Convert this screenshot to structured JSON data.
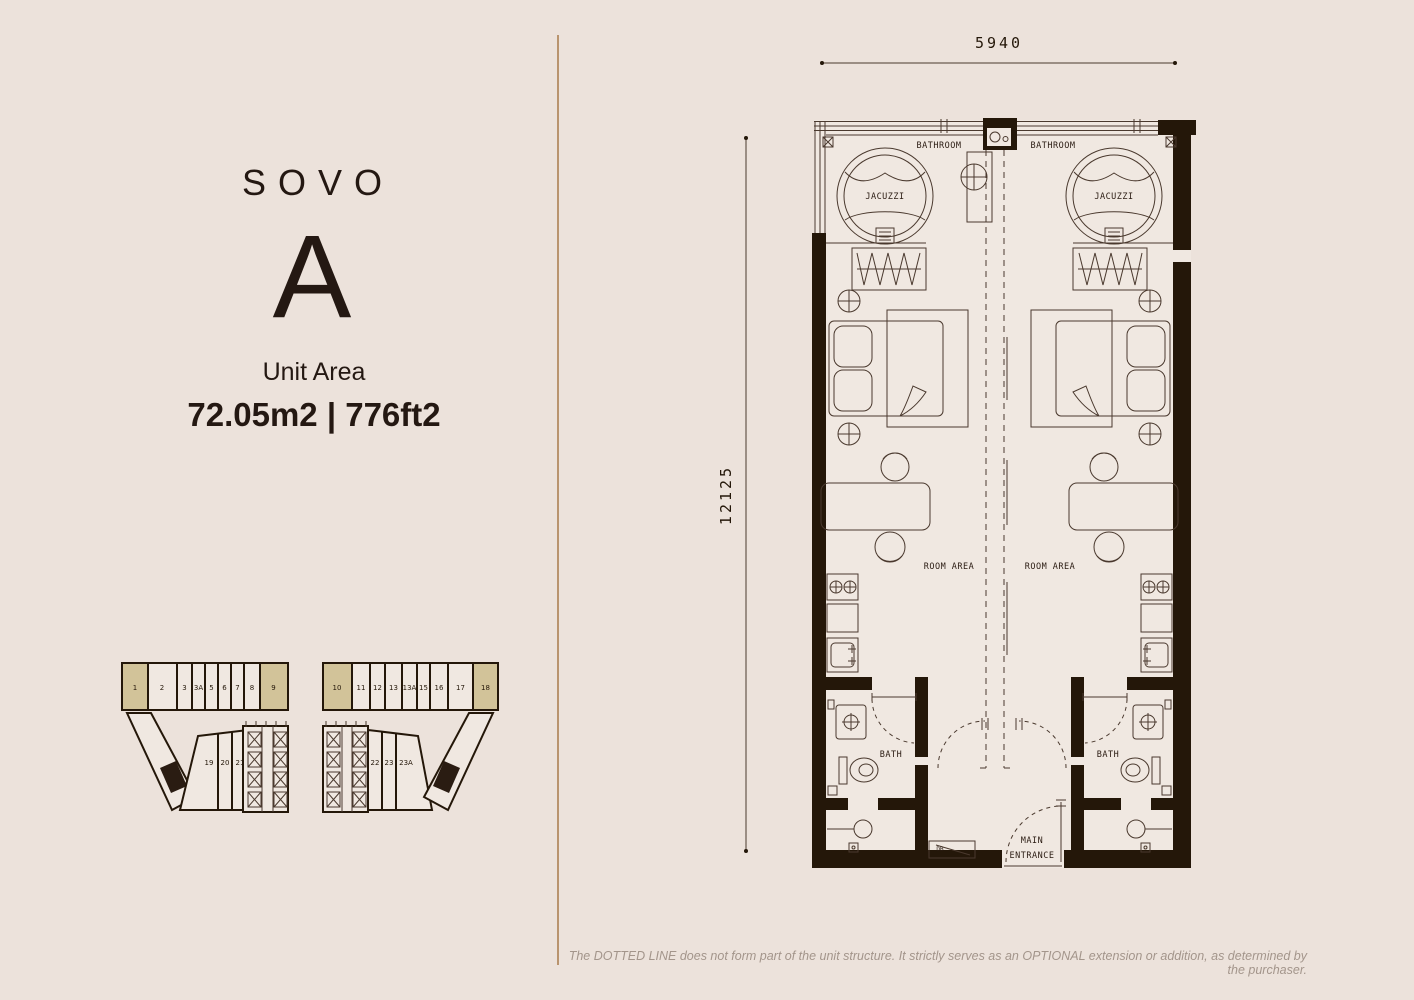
{
  "colors": {
    "background": "#ECE2DB",
    "plan_interior": "#F0E8E1",
    "wall_ink": "#241709",
    "line_ink": "#4A392E",
    "unit_highlight": "#D2C399",
    "divider_line": "#B9946E",
    "muted_text": "#A3958B"
  },
  "left_panel": {
    "brand": "SOVO",
    "unit_type": "A",
    "unit_area_label": "Unit Area",
    "unit_area_value": "72.05m2 | 776ft2"
  },
  "key_plan": {
    "left_block": {
      "top_units": [
        "1",
        "2",
        "3",
        "3A",
        "5",
        "6",
        "7",
        "8",
        "9"
      ],
      "highlighted_units": [
        "1",
        "9"
      ],
      "lower_units": [
        "19",
        "20",
        "21"
      ]
    },
    "right_block": {
      "top_units": [
        "10",
        "11",
        "12",
        "13",
        "13A",
        "15",
        "16",
        "17",
        "18"
      ],
      "highlighted_units": [
        "10",
        "18"
      ],
      "lower_units": [
        "22",
        "23",
        "23A"
      ]
    }
  },
  "floor_plan": {
    "dimensions": {
      "width_mm": "5940",
      "height_mm": "12125"
    },
    "labels": {
      "bathroom_left": "BATHROOM",
      "bathroom_right": "BATHROOM",
      "jacuzzi_left": "JACUZZI",
      "jacuzzi_right": "JACUZZI",
      "room_area_left": "ROOM AREA",
      "room_area_right": "ROOM AREA",
      "bath_left": "BATH",
      "bath_right": "BATH",
      "main_entrance_line1": "MAIN",
      "main_entrance_line2": "ENTRANCE",
      "db_box": "DB"
    }
  },
  "disclaimer": "The DOTTED LINE does not form part of the unit structure. It strictly serves as an OPTIONAL extension or addition, as determined by the purchaser."
}
